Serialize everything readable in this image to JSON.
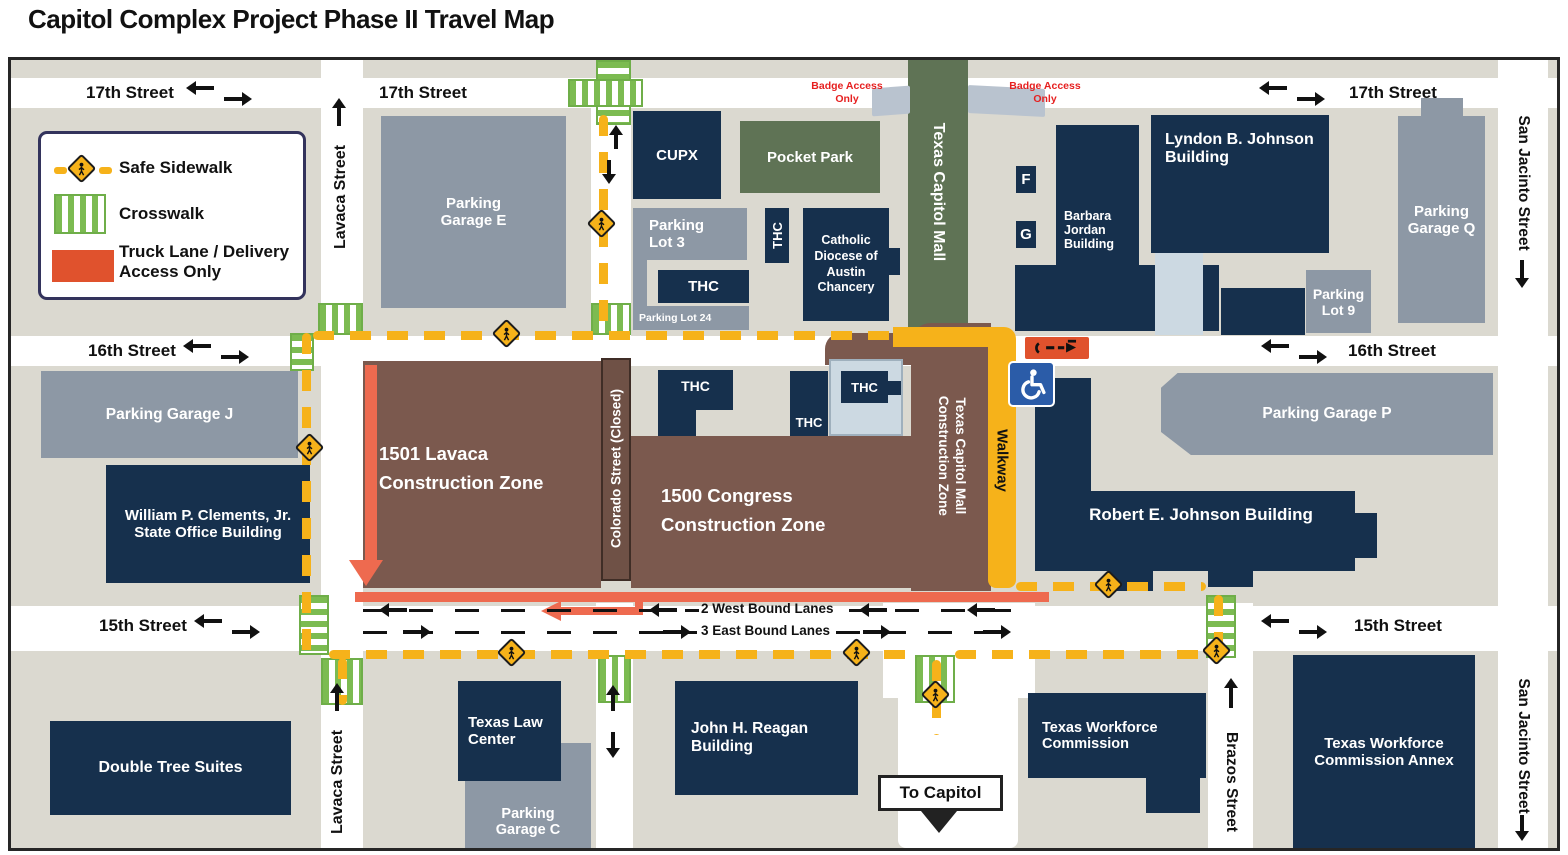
{
  "title": "Capitol Complex Project Phase II Travel Map",
  "legend": {
    "safe_sidewalk": "Safe Sidewalk",
    "crosswalk": "Crosswalk",
    "truck_lane": "Truck Lane / Delivery Access Only"
  },
  "streets": {
    "seventeenth": "17th Street",
    "sixteenth": "16th Street",
    "fifteenth": "15th Street",
    "lavaca": "Lavaca Street",
    "san_jacinto": "San Jacinto Street",
    "brazos": "Brazos Street",
    "colorado_closed": "Colorado Street (Closed)",
    "walkway": "Walkway",
    "west_lanes": "2 West Bound Lanes",
    "east_lanes": "3 East Bound Lanes",
    "to_capitol": "To Capitol",
    "badge_access": "Badge Access Only"
  },
  "areas": {
    "texas_capitol_mall": "Texas Capitol Mall",
    "pocket_park": "Pocket Park",
    "zone_1501": "1501 Lavaca Construction Zone",
    "zone_1500": "1500 Congress Construction Zone",
    "zone_tcm": "Texas Capitol Mall Construction Zone"
  },
  "buildings": {
    "parking_garage_e": "Parking Garage E",
    "cupx": "CUPX",
    "parking_lot_3": "Parking Lot 3",
    "thc": "THC",
    "catholic_diocese": "Catholic Diocese of Austin Chancery",
    "parking_lot_24": "Parking Lot 24",
    "lbj": "Lyndon B. Johnson Building",
    "barbara_jordan": "Barbara Jordan Building",
    "f": "F",
    "g": "G",
    "parking_lot_9": "Parking Lot 9",
    "parking_garage_q": "Parking Garage Q",
    "parking_garage_j": "Parking Garage J",
    "clements": "William P. Clements, Jr. State Office Building",
    "rej": "Robert E. Johnson Building",
    "parking_garage_p": "Parking Garage P",
    "double_tree": "Double Tree Suites",
    "texas_law": "Texas Law Center",
    "parking_garage_c": "Parking Garage C",
    "reagan": "John H. Reagan Building",
    "twc": "Texas Workforce Commission",
    "twc_annex": "Texas Workforce Commission Annex"
  },
  "colors": {
    "navy_building": "#16304d",
    "gray_building": "#8d98a5",
    "green_area": "#5f7355",
    "brown_zone": "#7b594e",
    "safe_sidewalk_yellow": "#f6b21a",
    "truck_lane_orange": "#e0522d",
    "truck_route_salmon": "#ee6a4f",
    "crosswalk_green": "#7cbb51",
    "badge_red": "#e62020",
    "block_gray": "#dbd9d0",
    "accessible_blue": "#2b5ca8"
  }
}
